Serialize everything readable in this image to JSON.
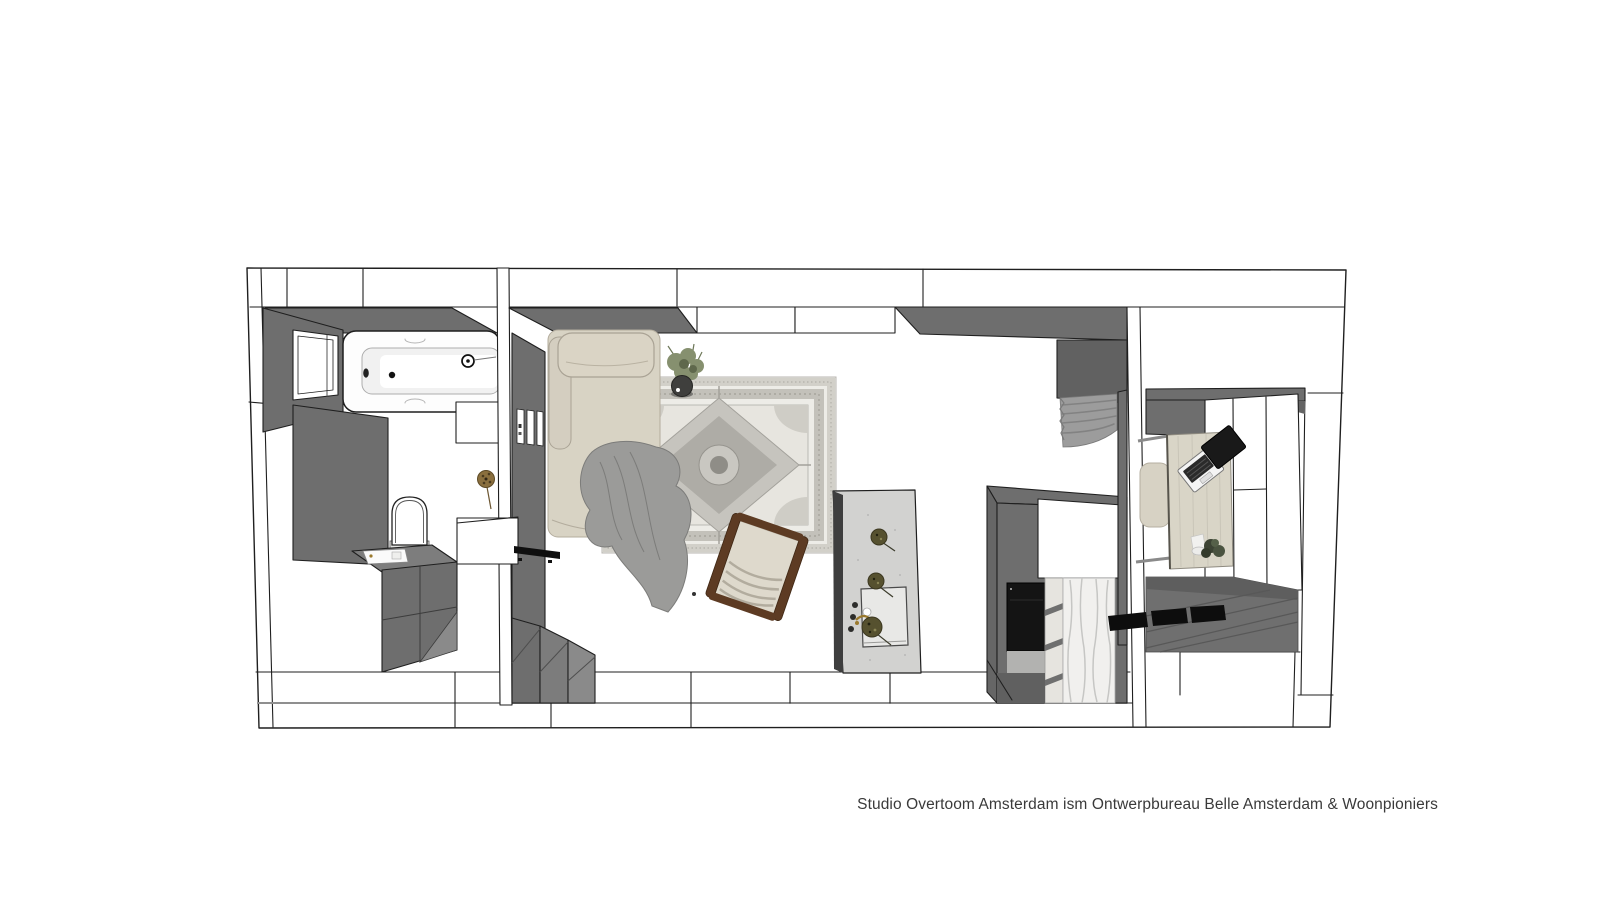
{
  "caption": {
    "text": "Studio Overtoom Amsterdam ism Ontwerpbureau Belle Amsterdam & Woonpioniers"
  },
  "palette": {
    "background": "#ffffff",
    "outline": "#1f1f1f",
    "line_soft": "#555555",
    "wall_dark": "#6e6e6e",
    "wall_medium": "#7d7d7d",
    "wall_shadow": "#616161",
    "step_gray": "#8a8a8a",
    "fixture_white": "#fdfdfd",
    "sofa_beige": "#d8d3c4",
    "sofa_edge": "#a9a294",
    "blanket_gray": "#9b9b99",
    "blanket_line": "#7c7c7a",
    "rug_base": "#edece7",
    "rug_field": "#e7e5df",
    "rug_border": "#c3c1ba",
    "rug_medallion": "#aeaca6",
    "wood_brown": "#5d3b23",
    "cushion_cream": "#ded9cc",
    "island_top": "#d2d2d0",
    "island_side": "#3e3e3e",
    "plant_green": "#86906f",
    "plant_green_dark": "#5f684c",
    "dried_brown": "#8a6f3e",
    "brass": "#9b7a2e",
    "oven_black": "#141414",
    "marble_white": "#f1f0ee",
    "marble_vein": "#c6c6c4",
    "desk_wood": "#d9d5c7",
    "laptop_black": "#191919",
    "mat_black": "#0d0d0d",
    "floor_plank": "#6f6f6f",
    "plank_line": "#585858",
    "caption_color": "#3a3a3a"
  }
}
